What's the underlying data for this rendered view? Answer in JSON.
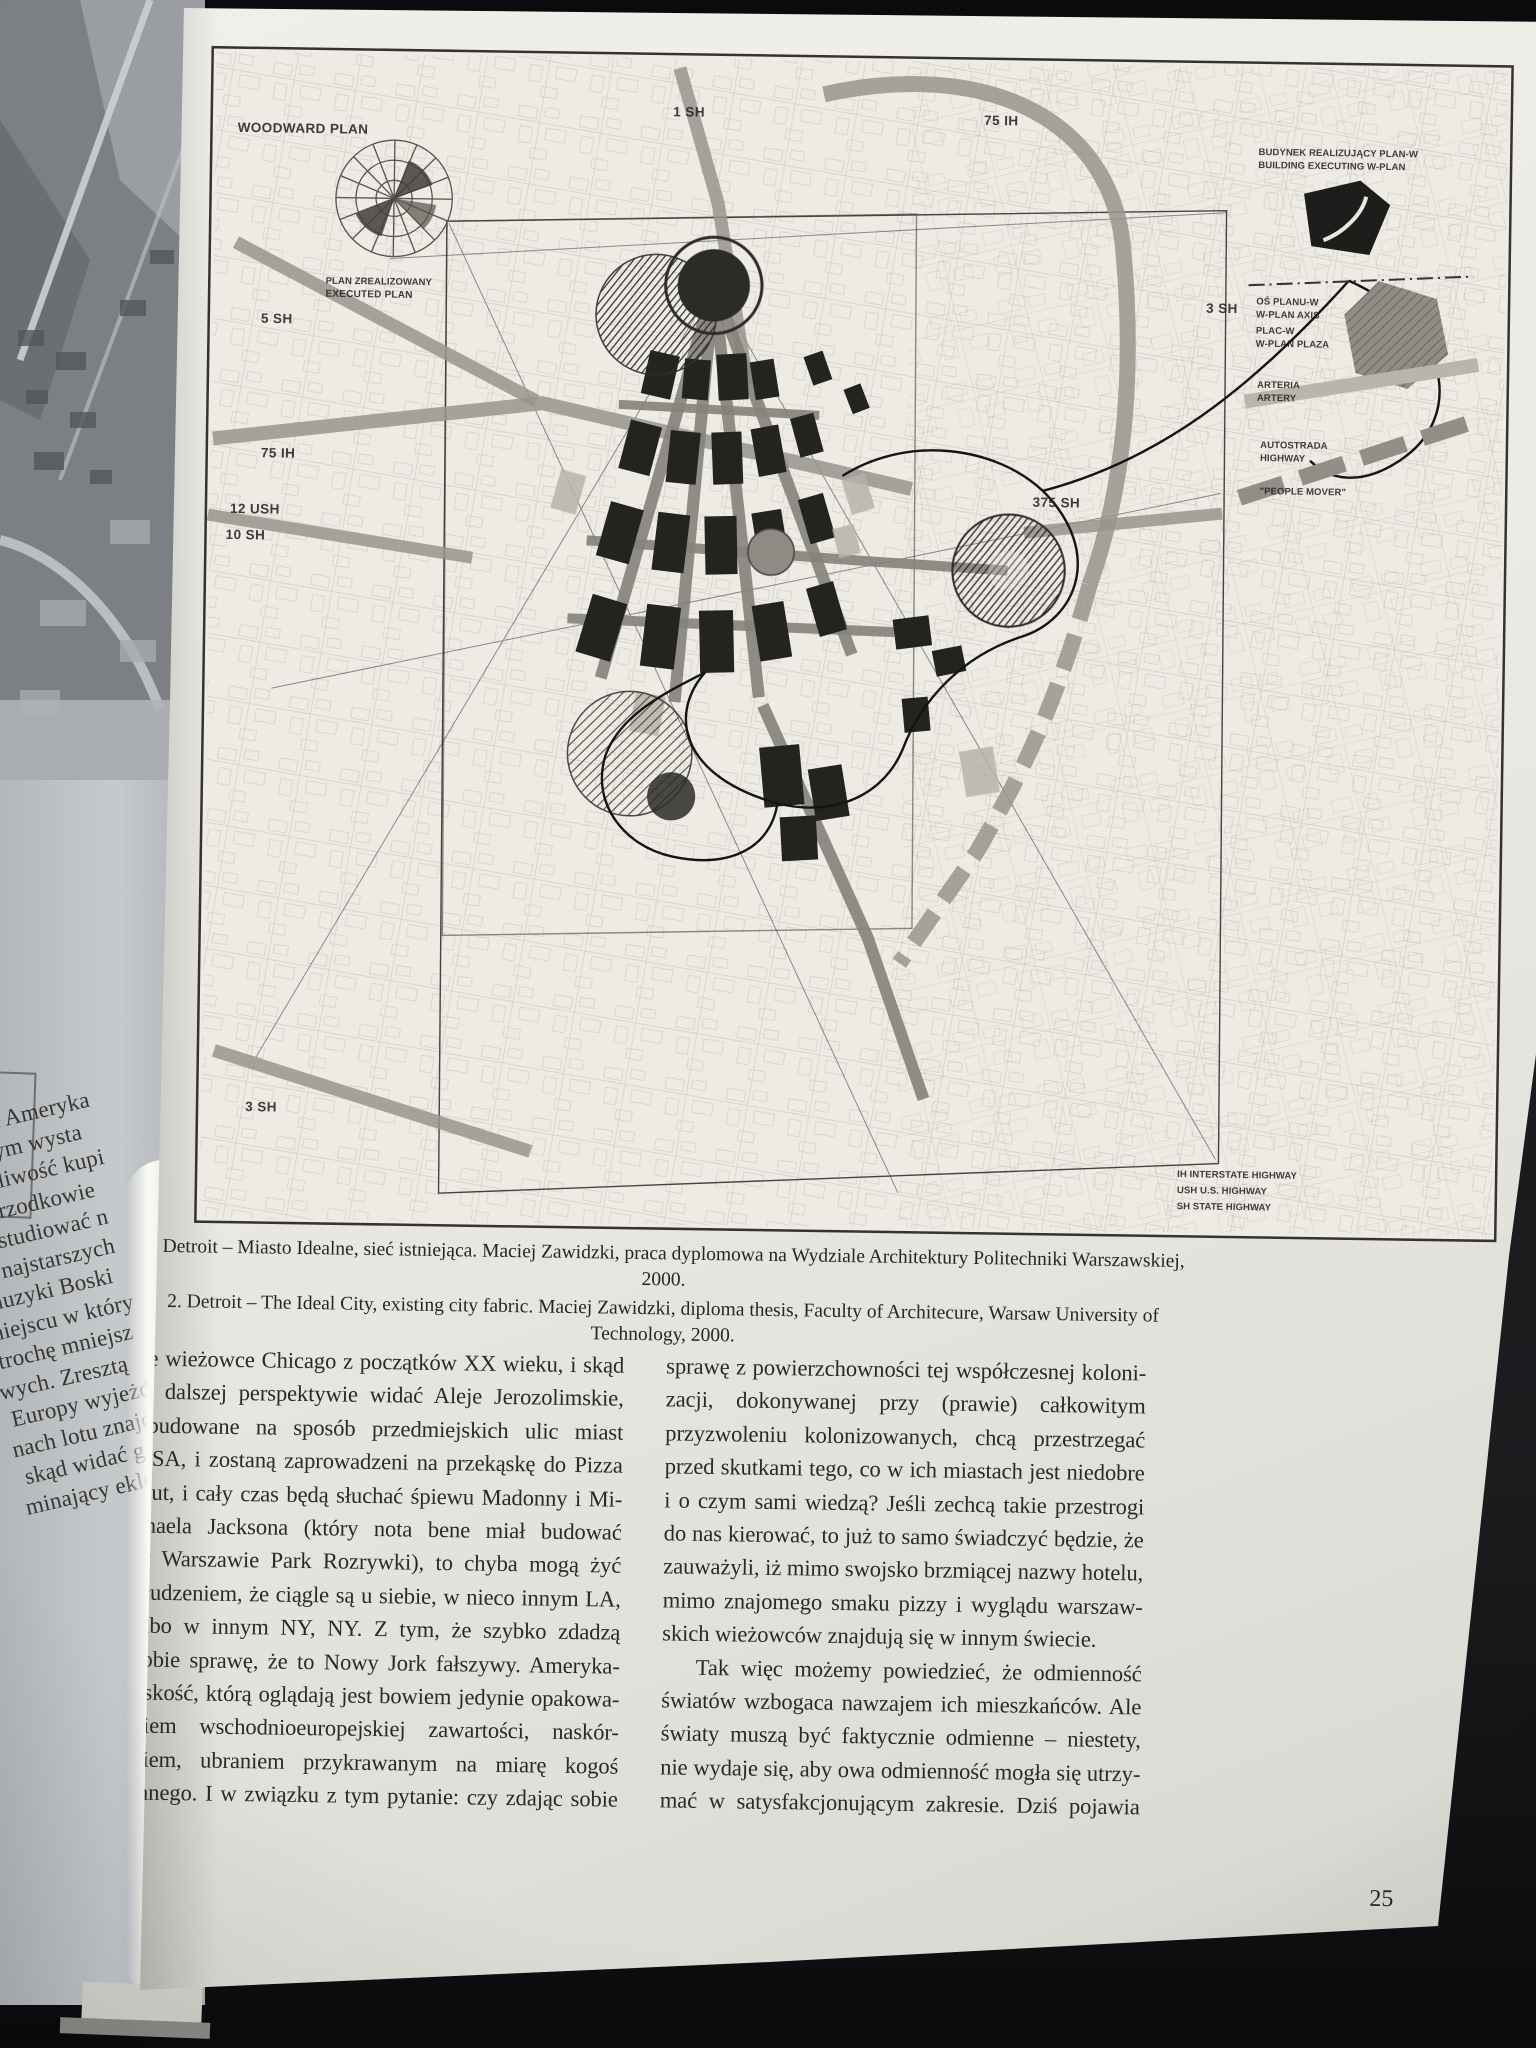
{
  "page": {
    "number": "25",
    "figure": {
      "caption_pl": "2. Detroit – Miasto Idealne, sieć istniejąca. Maciej Zawidzki, praca dyplomowa na Wydziale Architektury Politechniki Warszawskiej, 2000.",
      "caption_en": "2. Detroit – The Ideal City, existing city fabric. Maciej Zawidzki, diploma thesis, Faculty of Architecure, Warsaw University of Technology, 2000.",
      "map": {
        "labels": {
          "woodward_plan": "WOODWARD PLAN",
          "plan_executed_pl": "PLAN ZREALIZOWANY",
          "plan_executed_en": "EXECUTED PLAN",
          "sh1": "1 SH",
          "ih75_top": "75 IH",
          "sh5": "5 SH",
          "ih75_left": "75 IH",
          "ush12": "12 USH",
          "sh10": "10 SH",
          "sh3_right": "3 SH",
          "sh375": "375 SH",
          "sh3_bottom": "3 SH"
        },
        "legend": {
          "building_pl": "BUDYNEK REALIZUJĄCY PLAN-W",
          "building_en": "BUILDING EXECUTING W-PLAN",
          "axis_pl": "OŚ PLANU-W",
          "axis_en": "W-PLAN AXIS",
          "square_pl": "PLAC-W",
          "square_en": "W-PLAN PLAZA",
          "artery_pl": "ARTERIA",
          "artery_en": "ARTERY",
          "highway_pl": "AUTOSTRADA",
          "highway_en": "HIGHWAY",
          "people_mover": "\"PEOPLE MOVER\""
        },
        "key": [
          "IH   INTERSTATE HIGHWAY",
          "USH  U.S. HIGHWAY",
          "SH   STATE HIGHWAY"
        ]
      }
    },
    "body": {
      "left_lines": [
        "ne wieżowce Chicago z początków XX wieku, i skąd",
        "w dalszej perspektywie widać Aleje Jerozolimskie,",
        "obudowane na sposób przedmiejskich ulic miast",
        "USA, i zostaną zaprowadzeni na przekąskę do Pizza",
        "Hut, i cały czas będą słuchać śpiewu Madonny i Mi-",
        "chaela Jacksona (który nota bene miał budować",
        "w Warszawie Park Rozrywki), to chyba mogą żyć",
        "złudzeniem, że ciągle są u siebie, w nieco innym LA,",
        "albo w innym NY, NY. Z tym, że szybko zdadzą",
        "sobie sprawę, że to Nowy Jork fałszywy. Ameryka-",
        "ńskość, którą oglądają jest bowiem jedynie opakowa-",
        "niem wschodnioeuropejskiej zawartości, naskór-",
        "kiem, ubraniem przykrawanym na miarę kogoś",
        "innego. I w związku z tym pytanie: czy zdając sobie"
      ],
      "right_lines": [
        "sprawę z powierzchowności tej współczesnej koloni-",
        "zacji, dokonywanej przy (prawie) całkowitym",
        "przyzwoleniu kolonizowanych, chcą przestrzegać",
        "przed skutkami tego, co w ich miastach jest niedobre",
        "i o czym sami wiedzą? Jeśli zechcą takie przestrogi",
        "do nas kierować, to już to samo świadczyć będzie, że",
        "zauważyli, iż mimo swojsko brzmiącej nazwy hotelu,",
        "mimo znajomego smaku pizzy i wyglądu warszaw-",
        "skich wieżowców znajdują się w innym świecie.",
        "Tak więc możemy powiedzieć, że odmienność",
        "światów wzbogaca nawzajem ich mieszkańców. Ale",
        "światy muszą być faktycznie odmienne – niestety,",
        "nie wydaje się, aby owa odmienność mogła się utrzy-",
        "mać w satysfakcjonującym zakresie. Dziś pojawia"
      ]
    }
  },
  "prev_page": {
    "fragments": [
      "wnież Ameryka",
      "ektórym wysta",
      "możliwość kupi",
      "ch przodkowie",
      "zą studiować n",
      "do najstarszych",
      "muzyki Boski",
      "miejscu w który",
      "trochę mniejsz",
      "wych. Zresztą",
      "Europy wyjeżdż",
      "nach lotu znajd",
      "skąd widać g",
      "minający eklek"
    ]
  }
}
